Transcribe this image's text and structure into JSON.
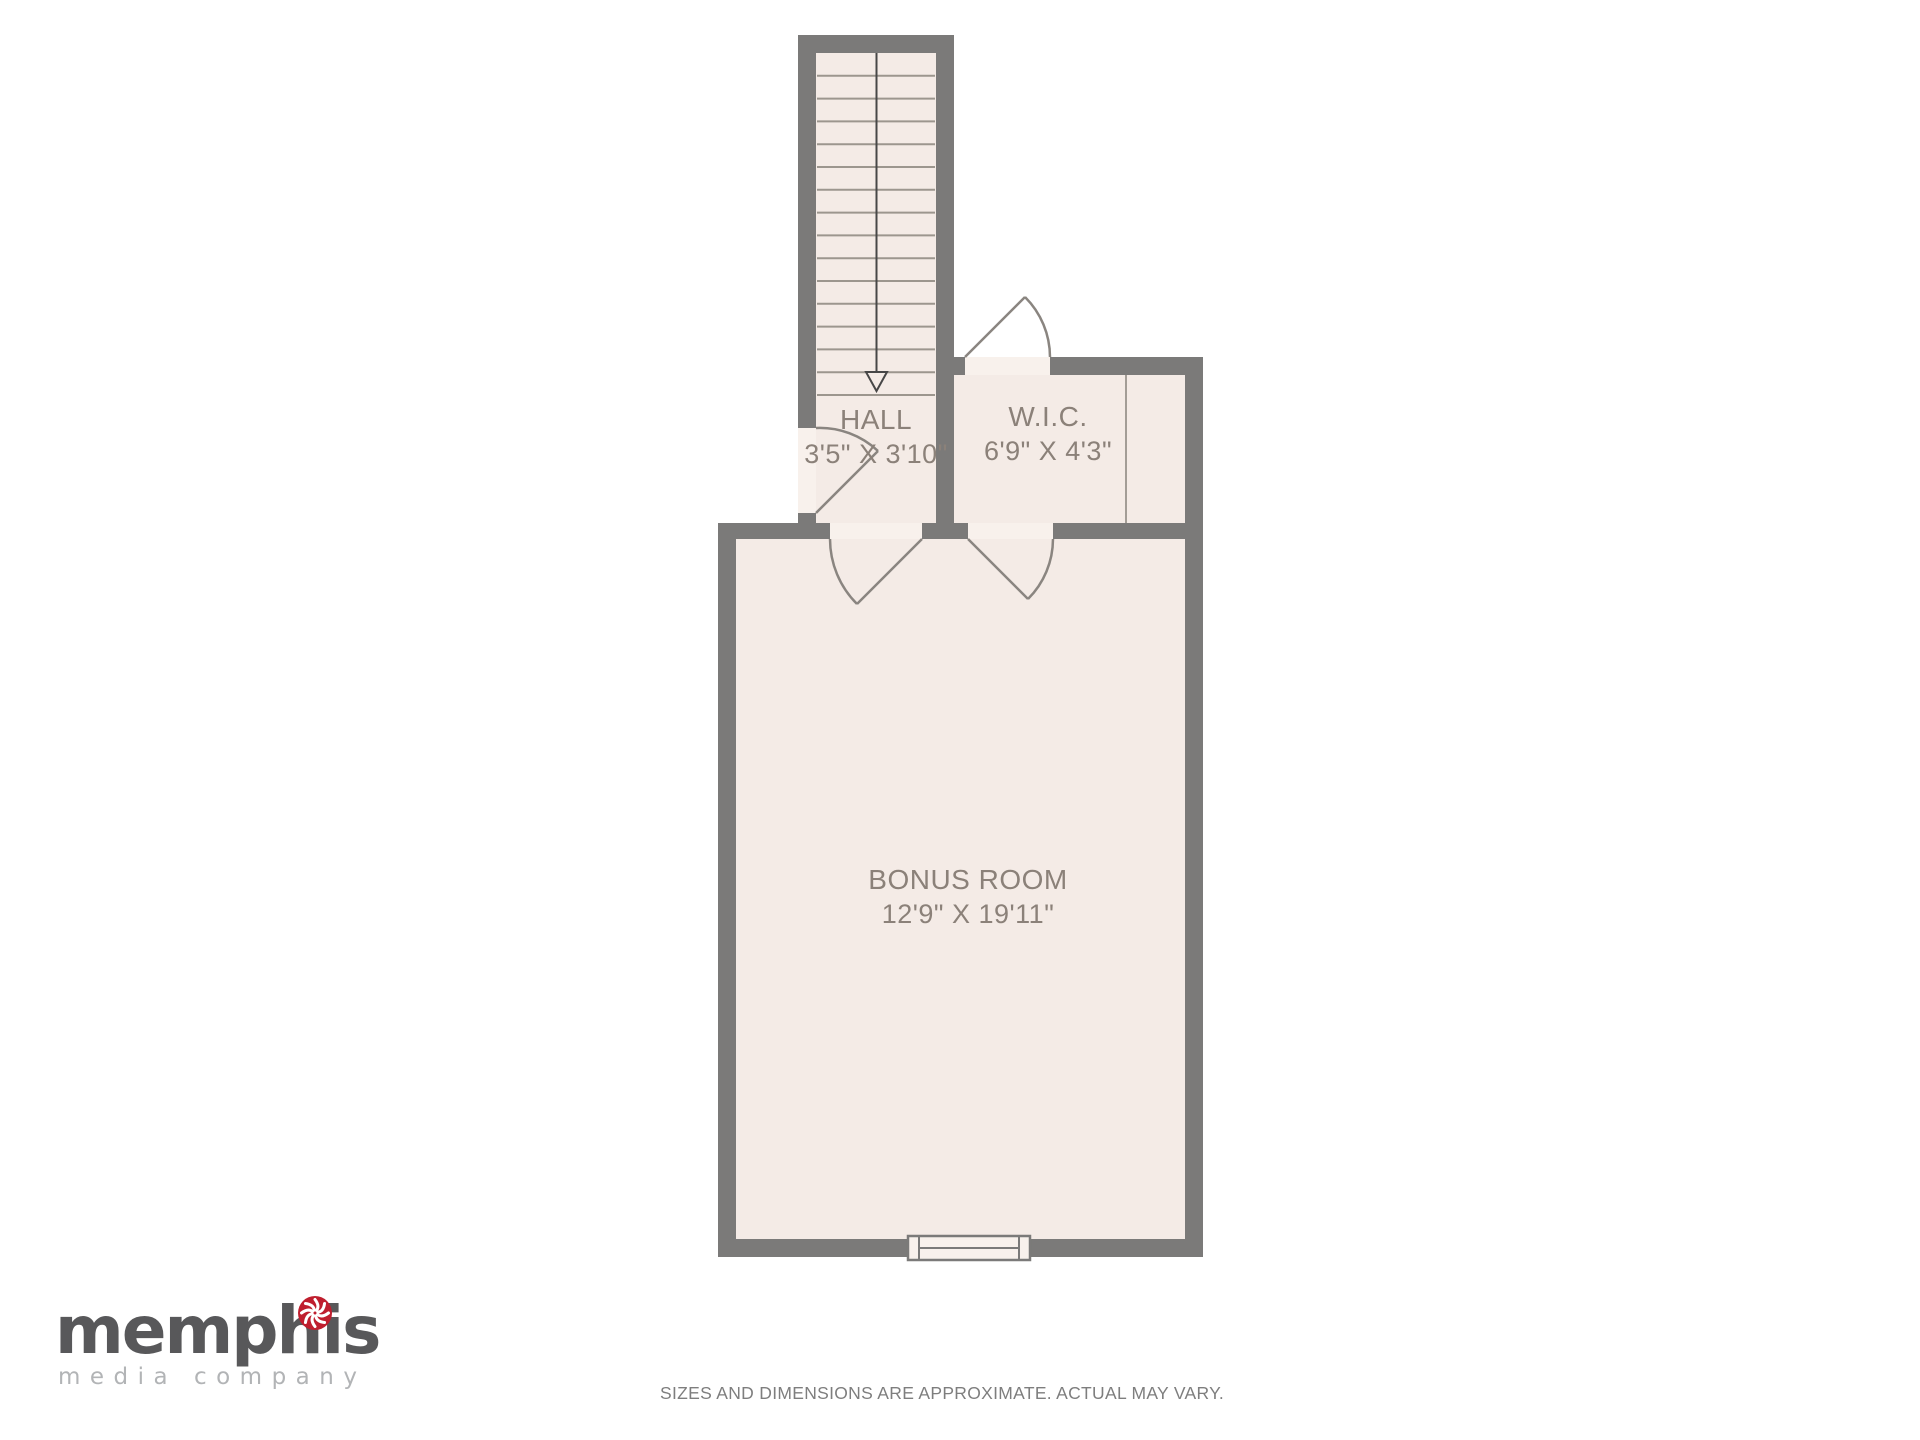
{
  "plan": {
    "rooms": [
      {
        "name": "HALL",
        "dimensions": "3'5\" X 3'10\""
      },
      {
        "name": "W.I.C.",
        "dimensions": "6'9\" X 4'3\""
      },
      {
        "name": "BONUS ROOM",
        "dimensions": "12'9\" X 19'11\""
      }
    ],
    "stairs": {
      "treads": 15,
      "direction_arrow": "down"
    },
    "doors": [
      "hall-entry-door",
      "wic-door",
      "hall-to-bonus-door",
      "wic-to-bonus-door"
    ],
    "window": "bonus-room-bottom-window"
  },
  "footer": {
    "disclaimer": "SIZES AND DIMENSIONS ARE APPROXIMATE. ACTUAL MAY VARY."
  },
  "logo": {
    "brand": "memphis",
    "tagline": "media company"
  },
  "colors": {
    "wall": "#7b7a79",
    "floor": "#f4ebe6",
    "threshold": "#f8f1ec",
    "label_text": "#8b8179",
    "logo_brand": "#58585a",
    "logo_tagline": "#b2b4b6",
    "logo_accent_red": "#bf1e2e"
  }
}
